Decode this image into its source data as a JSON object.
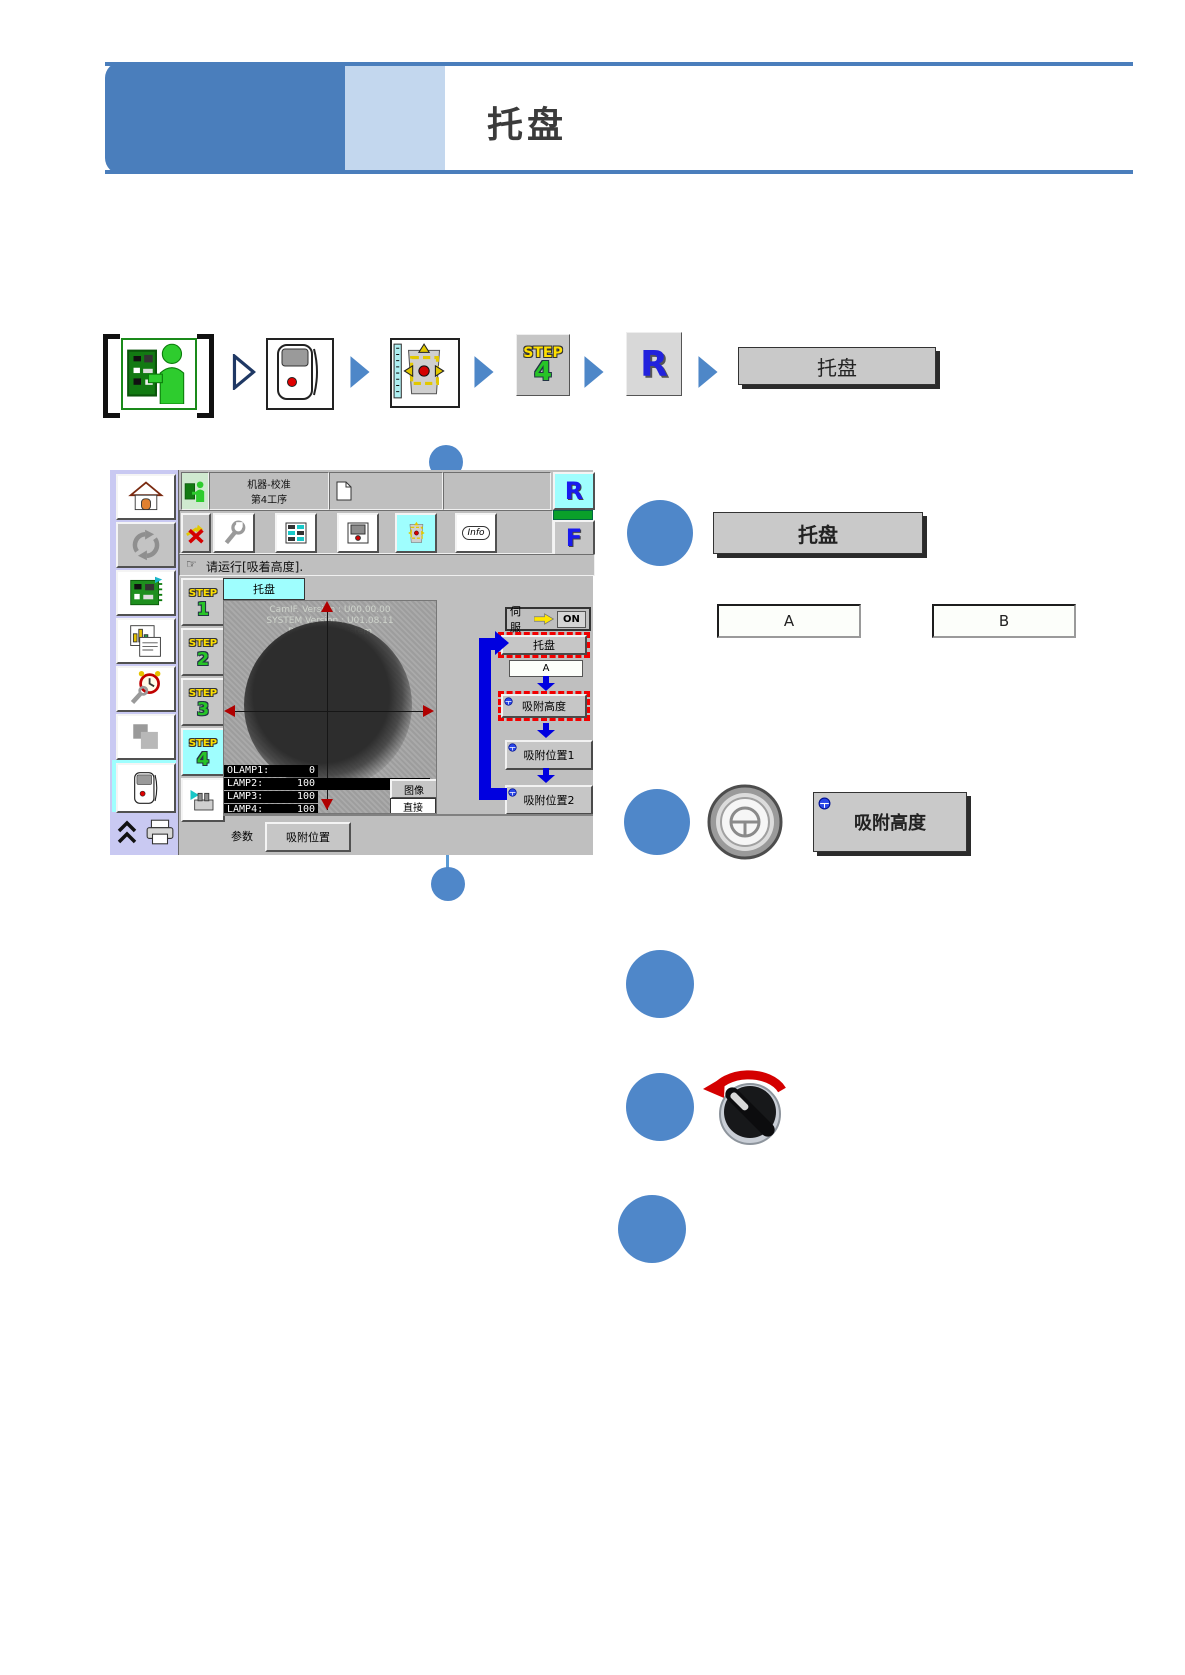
{
  "page": {
    "title": "托盘"
  },
  "nav": {
    "step_word": "STEP",
    "step_num": "4",
    "r_letter": "R",
    "tray_label": "托盘"
  },
  "screen": {
    "title_line1": "机器-校准",
    "title_line2": "第4工序",
    "r_letter": "R",
    "f_letter": "F",
    "info_label": "Info",
    "pointer_glyph": "☞",
    "message": "请运行[吸着高度].",
    "tab_label": "托盘",
    "steps": [
      {
        "word": "STEP",
        "num": "1"
      },
      {
        "word": "STEP",
        "num": "2"
      },
      {
        "word": "STEP",
        "num": "3"
      },
      {
        "word": "STEP",
        "num": "4"
      }
    ],
    "camera": {
      "version1": "CamIF. Version : U00.00.00",
      "version2": "SYSTEM Version : U01.08.11",
      "version3": "P9 ModularSystem",
      "lamps": [
        {
          "name": "OLAMP1:",
          "value": "0"
        },
        {
          "name": "LAMP2:",
          "value": "100"
        },
        {
          "name": "LAMP3:",
          "value": "100"
        },
        {
          "name": "LAMP4:",
          "value": "100"
        }
      ],
      "image_button": "图像",
      "direct_button": "直接"
    },
    "servo_label": "伺服",
    "servo_state": "ON",
    "flow_tray": "托盘",
    "flow_tray_value": "A",
    "flow_height": "吸附高度",
    "flow_pos1": "吸附位置1",
    "flow_pos2": "吸附位置2",
    "param_label": "参数",
    "param_button": "吸附位置"
  },
  "callout": {
    "tray_button": "托盘",
    "option_a": "A",
    "option_b": "B",
    "height_button": "吸附高度"
  },
  "colors": {
    "accent_blue": "#4f87c9",
    "header_blue": "#4a7ebc",
    "header_light_blue": "#c3d7ee",
    "highlight_cyan": "#9ffefe",
    "alert_red": "#f20000",
    "flow_arrow_blue": "#0000e0"
  }
}
